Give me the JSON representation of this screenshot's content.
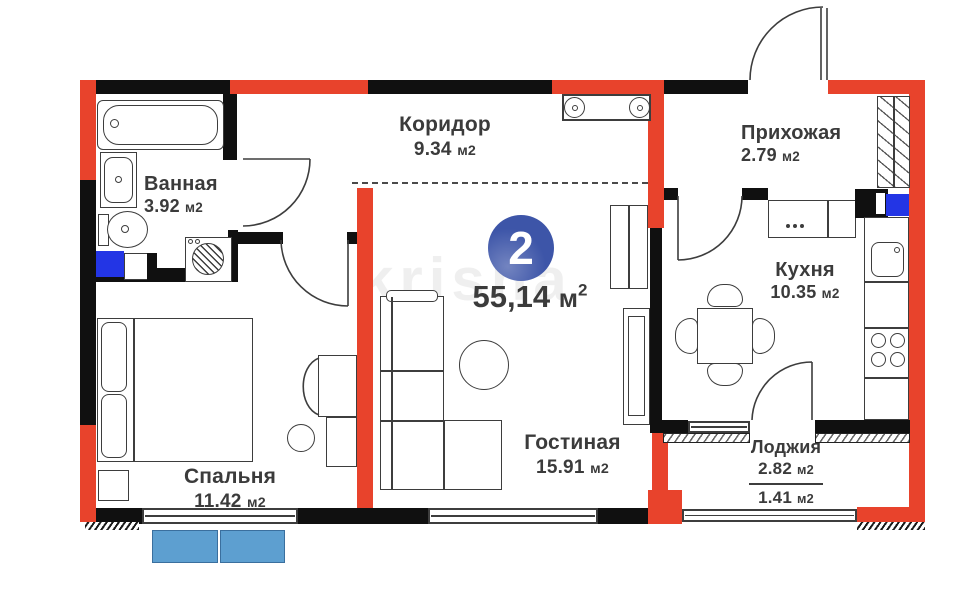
{
  "watermark": "krisha",
  "badge": {
    "rooms_count": "2",
    "area_value": "55,14",
    "area_unit": "м",
    "area_sup": "2"
  },
  "rooms": {
    "corridor": {
      "name": "Коридор",
      "area": "9.34",
      "unit": "м2"
    },
    "hallway": {
      "name": "Прихожая",
      "area": "2.79",
      "unit": "м2"
    },
    "bathroom": {
      "name": "Ванная",
      "area": "3.92",
      "unit": "м2"
    },
    "kitchen": {
      "name": "Кухня",
      "area": "10.35",
      "unit": "м2"
    },
    "bedroom": {
      "name": "Спальня",
      "area": "11.42",
      "unit": "м2"
    },
    "living_room": {
      "name": "Гостиная",
      "area": "15.91",
      "unit": "м2"
    },
    "loggia": {
      "name": "Лоджия",
      "area_total": "2.82",
      "area_counted": "1.41",
      "unit": "м2"
    }
  },
  "colors": {
    "wall_red": "#e8432c",
    "wall_black": "#101010",
    "badge_blue": "#3d55a8",
    "accent_blue": "#2335e5",
    "box_blue": "#5d9fd0",
    "text": "#3b3b3b"
  }
}
